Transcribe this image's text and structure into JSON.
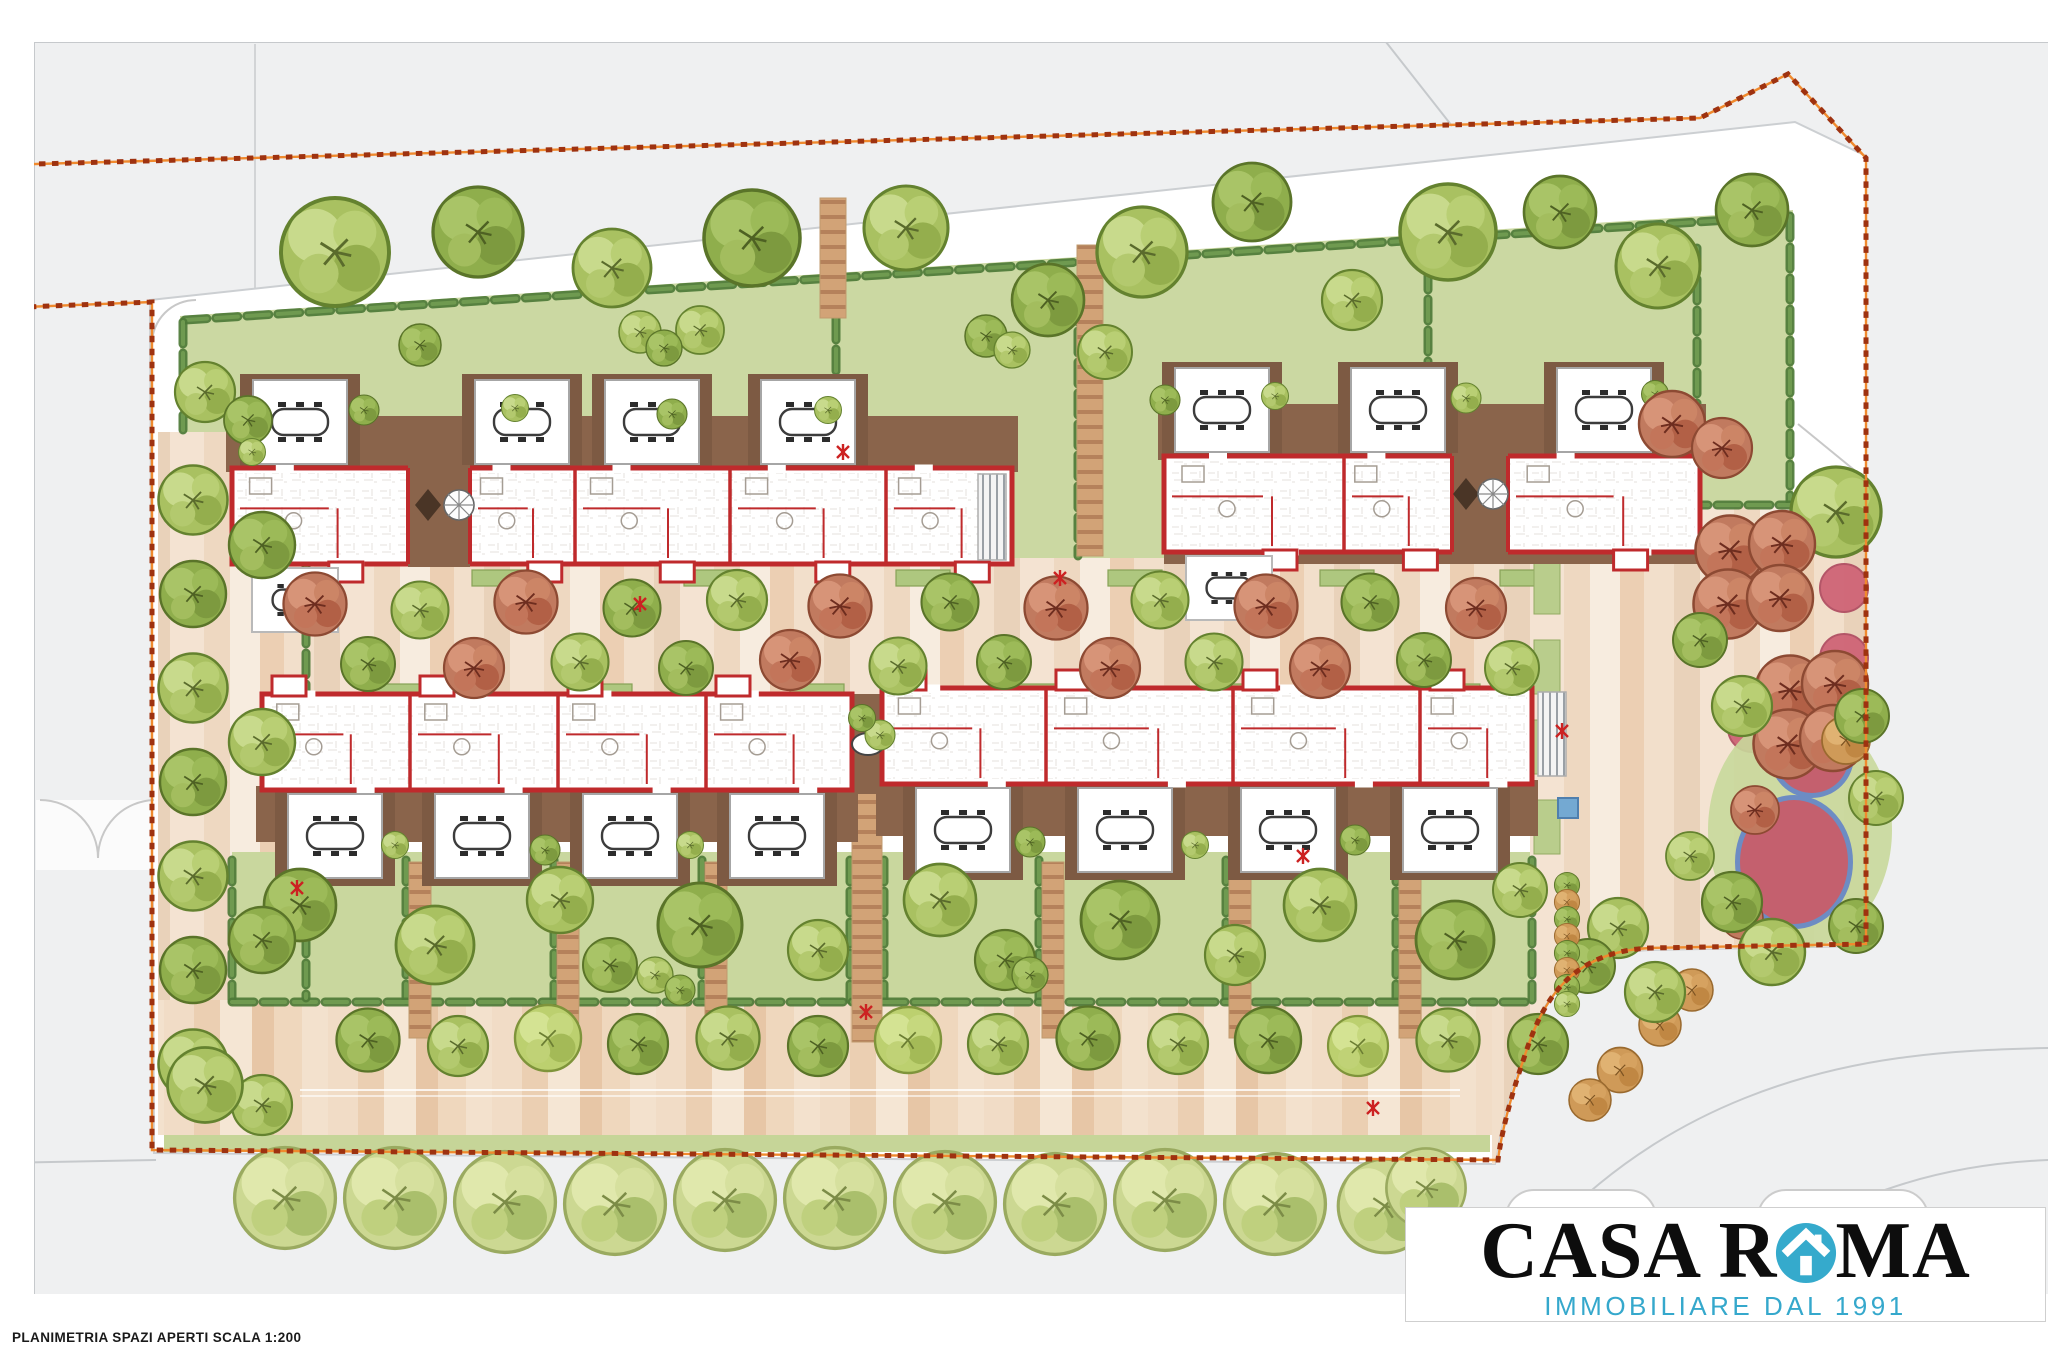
{
  "meta": {
    "caption": "PLANIMETRIA SPAZI APERTI SCALA 1:200"
  },
  "logo": {
    "part1": "CASA R",
    "part2": "MA",
    "tagline": "IMMOBILIARE DAL 1991",
    "icon": "house-in-circle-icon",
    "icon_color": "#35aacc",
    "text_color": "#0d0d0d",
    "tagline_color": "#35a8cc"
  },
  "palette": {
    "road": "#eff0f1",
    "road_line": "#c6c9cc",
    "site": "#ffffff",
    "garden": "#cbd8a2",
    "garden_strip": "#c6d598",
    "hedge": "#4e7a38",
    "hedge_light": "#6f9a50",
    "deck": "#8a644b",
    "deck_dark": "#7d5a43",
    "wall_red": "#bf2a2c",
    "paving_base": "#f2dfcd",
    "boundary": "#9e3210",
    "boundary_glow": "#f08a2e",
    "tree_green_1": "#a9c161",
    "tree_green_2": "#8fae4c",
    "tree_green_3": "#bcd06f",
    "tree_red": "#c17a5f",
    "tree_orange": "#cf9a58",
    "street_tree": "#ccd892",
    "pink_circle": "#cf6476",
    "play_red": "#c4606e",
    "play_blue": "#6d8cc3",
    "play_lawn": "#c8d89b",
    "planter_green": "#aec77f",
    "mark_red": "#cc2222"
  },
  "plan": {
    "buildings": [
      {
        "x": 232,
        "y": 468,
        "w": 780,
        "h": 96,
        "side": "top",
        "dividers": [
          575,
          730,
          886
        ],
        "gap": {
          "x": 408,
          "w": 62
        },
        "pergolas": [
          300,
          522,
          652,
          808
        ],
        "stair": [
          978,
          474,
          28,
          86
        ],
        "terrace": [
          252,
          568
        ]
      },
      {
        "x": 1164,
        "y": 456,
        "w": 536,
        "h": 96,
        "side": "top",
        "dividers": [
          1344
        ],
        "gap": {
          "x": 1452,
          "w": 56
        },
        "pergolas": [
          1222,
          1398,
          1604
        ],
        "terrace": [
          1186,
          556
        ],
        "deck_extra": [
          1164,
          552,
          536,
          12
        ]
      },
      {
        "x": 262,
        "y": 694,
        "w": 590,
        "h": 96,
        "side": "bottom",
        "dividers": [
          410,
          558,
          706
        ],
        "pergolas": [
          335,
          482,
          630,
          777
        ]
      },
      {
        "x": 882,
        "y": 688,
        "w": 650,
        "h": 96,
        "side": "bottom",
        "dividers": [
          1046,
          1233,
          1420
        ],
        "pergolas": [
          963,
          1125,
          1288,
          1450
        ],
        "stair": [
          1538,
          692,
          28,
          84
        ]
      }
    ],
    "connector_deck": [
      852,
      694,
      32,
      100
    ],
    "deck_tables": [
      {
        "type": "diamond",
        "x": 428,
        "y": 505
      },
      {
        "type": "parasol",
        "x": 459,
        "y": 505
      },
      {
        "type": "diamond",
        "x": 1466,
        "y": 494
      },
      {
        "type": "parasol",
        "x": 1493,
        "y": 494
      },
      {
        "type": "oval",
        "x": 868,
        "y": 744
      }
    ],
    "hedges": [
      [
        185,
        320,
        1790,
        216
      ],
      [
        183,
        322,
        183,
        430
      ],
      [
        836,
        318,
        836,
        424
      ],
      [
        1078,
        300,
        1078,
        556
      ],
      [
        1428,
        268,
        1428,
        408
      ],
      [
        1697,
        248,
        1697,
        502
      ],
      [
        1790,
        216,
        1790,
        502
      ],
      [
        1562,
        505,
        1790,
        505
      ],
      [
        232,
        860,
        232,
        1000
      ],
      [
        406,
        860,
        406,
        1000
      ],
      [
        554,
        860,
        554,
        1000
      ],
      [
        702,
        860,
        702,
        1000
      ],
      [
        850,
        860,
        850,
        1000
      ],
      [
        884,
        860,
        884,
        1000
      ],
      [
        1039,
        860,
        1039,
        1000
      ],
      [
        1226,
        860,
        1226,
        1000
      ],
      [
        1396,
        860,
        1396,
        1000
      ],
      [
        1532,
        860,
        1532,
        1000
      ],
      [
        232,
        1002,
        1530,
        1002
      ],
      [
        306,
        436,
        306,
        998
      ]
    ],
    "ladder_paths": [
      [
        833,
        198,
        318,
        26
      ],
      [
        1090,
        245,
        556,
        26
      ],
      [
        867,
        792,
        1042,
        30
      ],
      [
        420,
        862,
        1038,
        22
      ],
      [
        568,
        862,
        1038,
        22
      ],
      [
        716,
        862,
        1038,
        22
      ],
      [
        1053,
        862,
        1038,
        22
      ],
      [
        1240,
        862,
        1038,
        22
      ],
      [
        1410,
        862,
        1038,
        22
      ]
    ],
    "planter_rows": [
      {
        "y": 570,
        "w": 54,
        "h": 16,
        "xs": [
          260,
          472,
          684,
          896,
          1108,
          1320,
          1500
        ]
      },
      {
        "y": 684,
        "w": 54,
        "h": 16,
        "xs": [
          366,
          578,
          790,
          1002,
          1214,
          1426
        ]
      }
    ],
    "grass_patches": [
      [
        1534,
        560,
        26,
        54
      ],
      [
        1534,
        640,
        26,
        54
      ],
      [
        1534,
        720,
        26,
        54
      ],
      [
        1534,
        800,
        26,
        54
      ]
    ],
    "pink_circles": {
      "r": 24,
      "pts": [
        [
          1844,
          588
        ],
        [
          1844,
          658
        ],
        [
          1752,
          728
        ]
      ]
    },
    "blue_square": [
      1558,
      798,
      20,
      20
    ],
    "red_marks": [
      [
        843,
        452
      ],
      [
        1060,
        578
      ],
      [
        866,
        1012
      ],
      [
        1373,
        1108
      ],
      [
        1562,
        731
      ],
      [
        297,
        888
      ],
      [
        1303,
        856
      ],
      [
        640,
        604
      ]
    ],
    "trees": {
      "top_gardens": [
        [
          335,
          252,
          1.8,
          "g1"
        ],
        [
          478,
          232,
          1.5,
          "g2"
        ],
        [
          612,
          268,
          1.3,
          "g1"
        ],
        [
          752,
          238,
          1.6,
          "g2"
        ],
        [
          700,
          330,
          0.8,
          "g1"
        ],
        [
          906,
          228,
          1.4,
          "g1"
        ],
        [
          1048,
          300,
          1.2,
          "g2"
        ],
        [
          1142,
          252,
          1.5,
          "g1"
        ],
        [
          1252,
          202,
          1.3,
          "g2"
        ],
        [
          1352,
          300,
          1.0,
          "g1"
        ],
        [
          1448,
          232,
          1.6,
          "g1"
        ],
        [
          1560,
          212,
          1.2,
          "g2"
        ],
        [
          1658,
          266,
          1.4,
          "g1"
        ],
        [
          1752,
          210,
          1.2,
          "g2"
        ],
        [
          640,
          332,
          0.7,
          "g1"
        ],
        [
          664,
          348,
          0.6,
          "g2"
        ],
        [
          986,
          336,
          0.7,
          "g2"
        ],
        [
          1012,
          350,
          0.6,
          "g1"
        ],
        [
          205,
          392,
          1.0,
          "g1"
        ],
        [
          248,
          420,
          0.8,
          "g2"
        ],
        [
          420,
          345,
          0.7,
          "g2"
        ],
        [
          1105,
          352,
          0.9,
          "g1"
        ],
        [
          1836,
          512,
          1.5,
          "g1"
        ]
      ],
      "deck_shrubs": [
        [
          364,
          410,
          0.5,
          "g2"
        ],
        [
          252,
          452,
          0.45,
          "g1"
        ],
        [
          515,
          408,
          0.45,
          "g1"
        ],
        [
          672,
          414,
          0.5,
          "g2"
        ],
        [
          828,
          410,
          0.45,
          "g1"
        ],
        [
          1165,
          400,
          0.5,
          "g2"
        ],
        [
          1275,
          396,
          0.45,
          "g1"
        ],
        [
          1466,
          398,
          0.5,
          "g1"
        ],
        [
          1655,
          394,
          0.45,
          "g2"
        ],
        [
          880,
          735,
          0.5,
          "g1"
        ],
        [
          862,
          718,
          0.45,
          "g2"
        ],
        [
          395,
          845,
          0.45,
          "g1"
        ],
        [
          545,
          850,
          0.5,
          "g2"
        ],
        [
          690,
          845,
          0.45,
          "g1"
        ],
        [
          1030,
          842,
          0.5,
          "g2"
        ],
        [
          1195,
          845,
          0.45,
          "g1"
        ],
        [
          1355,
          840,
          0.5,
          "g2"
        ]
      ],
      "courtyard": [
        [
          315,
          604,
          1.05,
          "red"
        ],
        [
          420,
          610,
          0.95,
          "g1"
        ],
        [
          526,
          602,
          1.05,
          "red"
        ],
        [
          632,
          608,
          0.95,
          "g2"
        ],
        [
          737,
          600,
          1.0,
          "g1"
        ],
        [
          840,
          606,
          1.05,
          "red"
        ],
        [
          950,
          602,
          0.95,
          "g2"
        ],
        [
          1056,
          608,
          1.05,
          "red"
        ],
        [
          1160,
          600,
          0.95,
          "g1"
        ],
        [
          1266,
          606,
          1.05,
          "red"
        ],
        [
          1370,
          602,
          0.95,
          "g2"
        ],
        [
          1476,
          608,
          1.0,
          "red"
        ],
        [
          368,
          664,
          0.9,
          "g2"
        ],
        [
          474,
          668,
          1.0,
          "red"
        ],
        [
          580,
          662,
          0.95,
          "g1"
        ],
        [
          686,
          668,
          0.9,
          "g2"
        ],
        [
          790,
          660,
          1.0,
          "red"
        ],
        [
          898,
          666,
          0.95,
          "g1"
        ],
        [
          1004,
          662,
          0.9,
          "g2"
        ],
        [
          1110,
          668,
          1.0,
          "red"
        ],
        [
          1214,
          662,
          0.95,
          "g1"
        ],
        [
          1320,
          668,
          1.0,
          "red"
        ],
        [
          1424,
          660,
          0.9,
          "g2"
        ],
        [
          1512,
          668,
          0.9,
          "g1"
        ]
      ],
      "south_gardens": [
        [
          300,
          905,
          1.2,
          "g2"
        ],
        [
          435,
          945,
          1.3,
          "g1"
        ],
        [
          560,
          900,
          1.1,
          "g1"
        ],
        [
          610,
          965,
          0.9,
          "g2"
        ],
        [
          700,
          925,
          1.4,
          "g2"
        ],
        [
          818,
          950,
          1.0,
          "g1"
        ],
        [
          940,
          900,
          1.2,
          "g1"
        ],
        [
          1005,
          960,
          1.0,
          "g2"
        ],
        [
          1120,
          920,
          1.3,
          "g2"
        ],
        [
          1235,
          955,
          1.0,
          "g1"
        ],
        [
          1320,
          905,
          1.2,
          "g1"
        ],
        [
          1455,
          940,
          1.3,
          "g2"
        ],
        [
          1520,
          890,
          0.9,
          "g1"
        ],
        [
          655,
          975,
          0.6,
          "g1"
        ],
        [
          680,
          990,
          0.5,
          "g2"
        ],
        [
          1030,
          975,
          0.6,
          "g2"
        ]
      ],
      "left_strip": [
        [
          193,
          500,
          1.15,
          "g1"
        ],
        [
          193,
          594,
          1.1,
          "g2"
        ],
        [
          193,
          688,
          1.15,
          "g1"
        ],
        [
          193,
          782,
          1.1,
          "g2"
        ],
        [
          193,
          876,
          1.15,
          "g1"
        ],
        [
          193,
          970,
          1.1,
          "g2"
        ],
        [
          193,
          1064,
          1.15,
          "g1"
        ],
        [
          262,
          545,
          1.1,
          "g2"
        ],
        [
          262,
          742,
          1.1,
          "g1"
        ],
        [
          262,
          940,
          1.1,
          "g2"
        ],
        [
          262,
          1105,
          1.0,
          "g1"
        ]
      ],
      "promenade_row": [
        [
          368,
          1040,
          1.05,
          "g2"
        ],
        [
          458,
          1046,
          1.0,
          "g1"
        ],
        [
          548,
          1038,
          1.1,
          "g3"
        ],
        [
          638,
          1044,
          1.0,
          "g2"
        ],
        [
          728,
          1038,
          1.05,
          "g1"
        ],
        [
          818,
          1046,
          1.0,
          "g2"
        ],
        [
          908,
          1040,
          1.1,
          "g3"
        ],
        [
          998,
          1044,
          1.0,
          "g1"
        ],
        [
          1088,
          1038,
          1.05,
          "g2"
        ],
        [
          1178,
          1044,
          1.0,
          "g1"
        ],
        [
          1268,
          1040,
          1.1,
          "g2"
        ],
        [
          1358,
          1046,
          1.0,
          "g3"
        ],
        [
          1448,
          1040,
          1.05,
          "g1"
        ],
        [
          1538,
          1044,
          1.0,
          "g2"
        ],
        [
          205,
          1085,
          1.25,
          "g1"
        ]
      ],
      "street_row": [
        [
          285,
          1198,
          1.4,
          "st"
        ],
        [
          395,
          1198,
          1.4,
          "st"
        ],
        [
          505,
          1202,
          1.4,
          "st"
        ],
        [
          615,
          1204,
          1.4,
          "st"
        ],
        [
          725,
          1200,
          1.4,
          "st"
        ],
        [
          835,
          1198,
          1.4,
          "st"
        ],
        [
          945,
          1202,
          1.4,
          "st"
        ],
        [
          1055,
          1204,
          1.4,
          "st"
        ],
        [
          1165,
          1200,
          1.4,
          "st"
        ],
        [
          1275,
          1204,
          1.4,
          "st"
        ],
        [
          1385,
          1206,
          1.3,
          "st"
        ],
        [
          1426,
          1188,
          1.1,
          "st"
        ]
      ],
      "plaza": [
        [
          1672,
          424,
          1.1,
          "red"
        ],
        [
          1722,
          448,
          1.0,
          "red"
        ],
        [
          1730,
          550,
          1.15,
          "red"
        ],
        [
          1782,
          544,
          1.1,
          "red"
        ],
        [
          1728,
          604,
          1.15,
          "red"
        ],
        [
          1780,
          598,
          1.1,
          "red"
        ],
        [
          1790,
          690,
          1.15,
          "red"
        ],
        [
          1835,
          684,
          1.1,
          "red"
        ],
        [
          1788,
          744,
          1.15,
          "red"
        ],
        [
          1833,
          738,
          1.1,
          "red"
        ],
        [
          1755,
          810,
          0.8,
          "red"
        ],
        [
          1742,
          918,
          0.7,
          "red"
        ],
        [
          1846,
          740,
          0.8,
          "or"
        ],
        [
          1620,
          1070,
          0.75,
          "or"
        ],
        [
          1660,
          1025,
          0.7,
          "or"
        ],
        [
          1692,
          990,
          0.7,
          "or"
        ],
        [
          1590,
          1100,
          0.7,
          "or"
        ],
        [
          1742,
          706,
          1.0,
          "g1"
        ],
        [
          1862,
          716,
          0.9,
          "g2"
        ],
        [
          1876,
          798,
          0.9,
          "g1"
        ],
        [
          1732,
          902,
          1.0,
          "g2"
        ],
        [
          1772,
          952,
          1.1,
          "g1"
        ],
        [
          1856,
          926,
          0.9,
          "g2"
        ],
        [
          1690,
          856,
          0.8,
          "g1"
        ],
        [
          1618,
          928,
          1.0,
          "g1"
        ],
        [
          1588,
          966,
          0.9,
          "g2"
        ],
        [
          1655,
          992,
          1.0,
          "g1"
        ],
        [
          1700,
          640,
          0.9,
          "g2"
        ]
      ],
      "cypress_row": [
        [
          1567,
          885,
          0.42,
          "g2"
        ],
        [
          1567,
          902,
          0.42,
          "or"
        ],
        [
          1567,
          919,
          0.42,
          "g2"
        ],
        [
          1567,
          936,
          0.42,
          "or"
        ],
        [
          1567,
          953,
          0.42,
          "g2"
        ],
        [
          1567,
          970,
          0.42,
          "or"
        ],
        [
          1567,
          987,
          0.42,
          "g2"
        ],
        [
          1567,
          1004,
          0.42,
          "g1"
        ]
      ]
    }
  }
}
